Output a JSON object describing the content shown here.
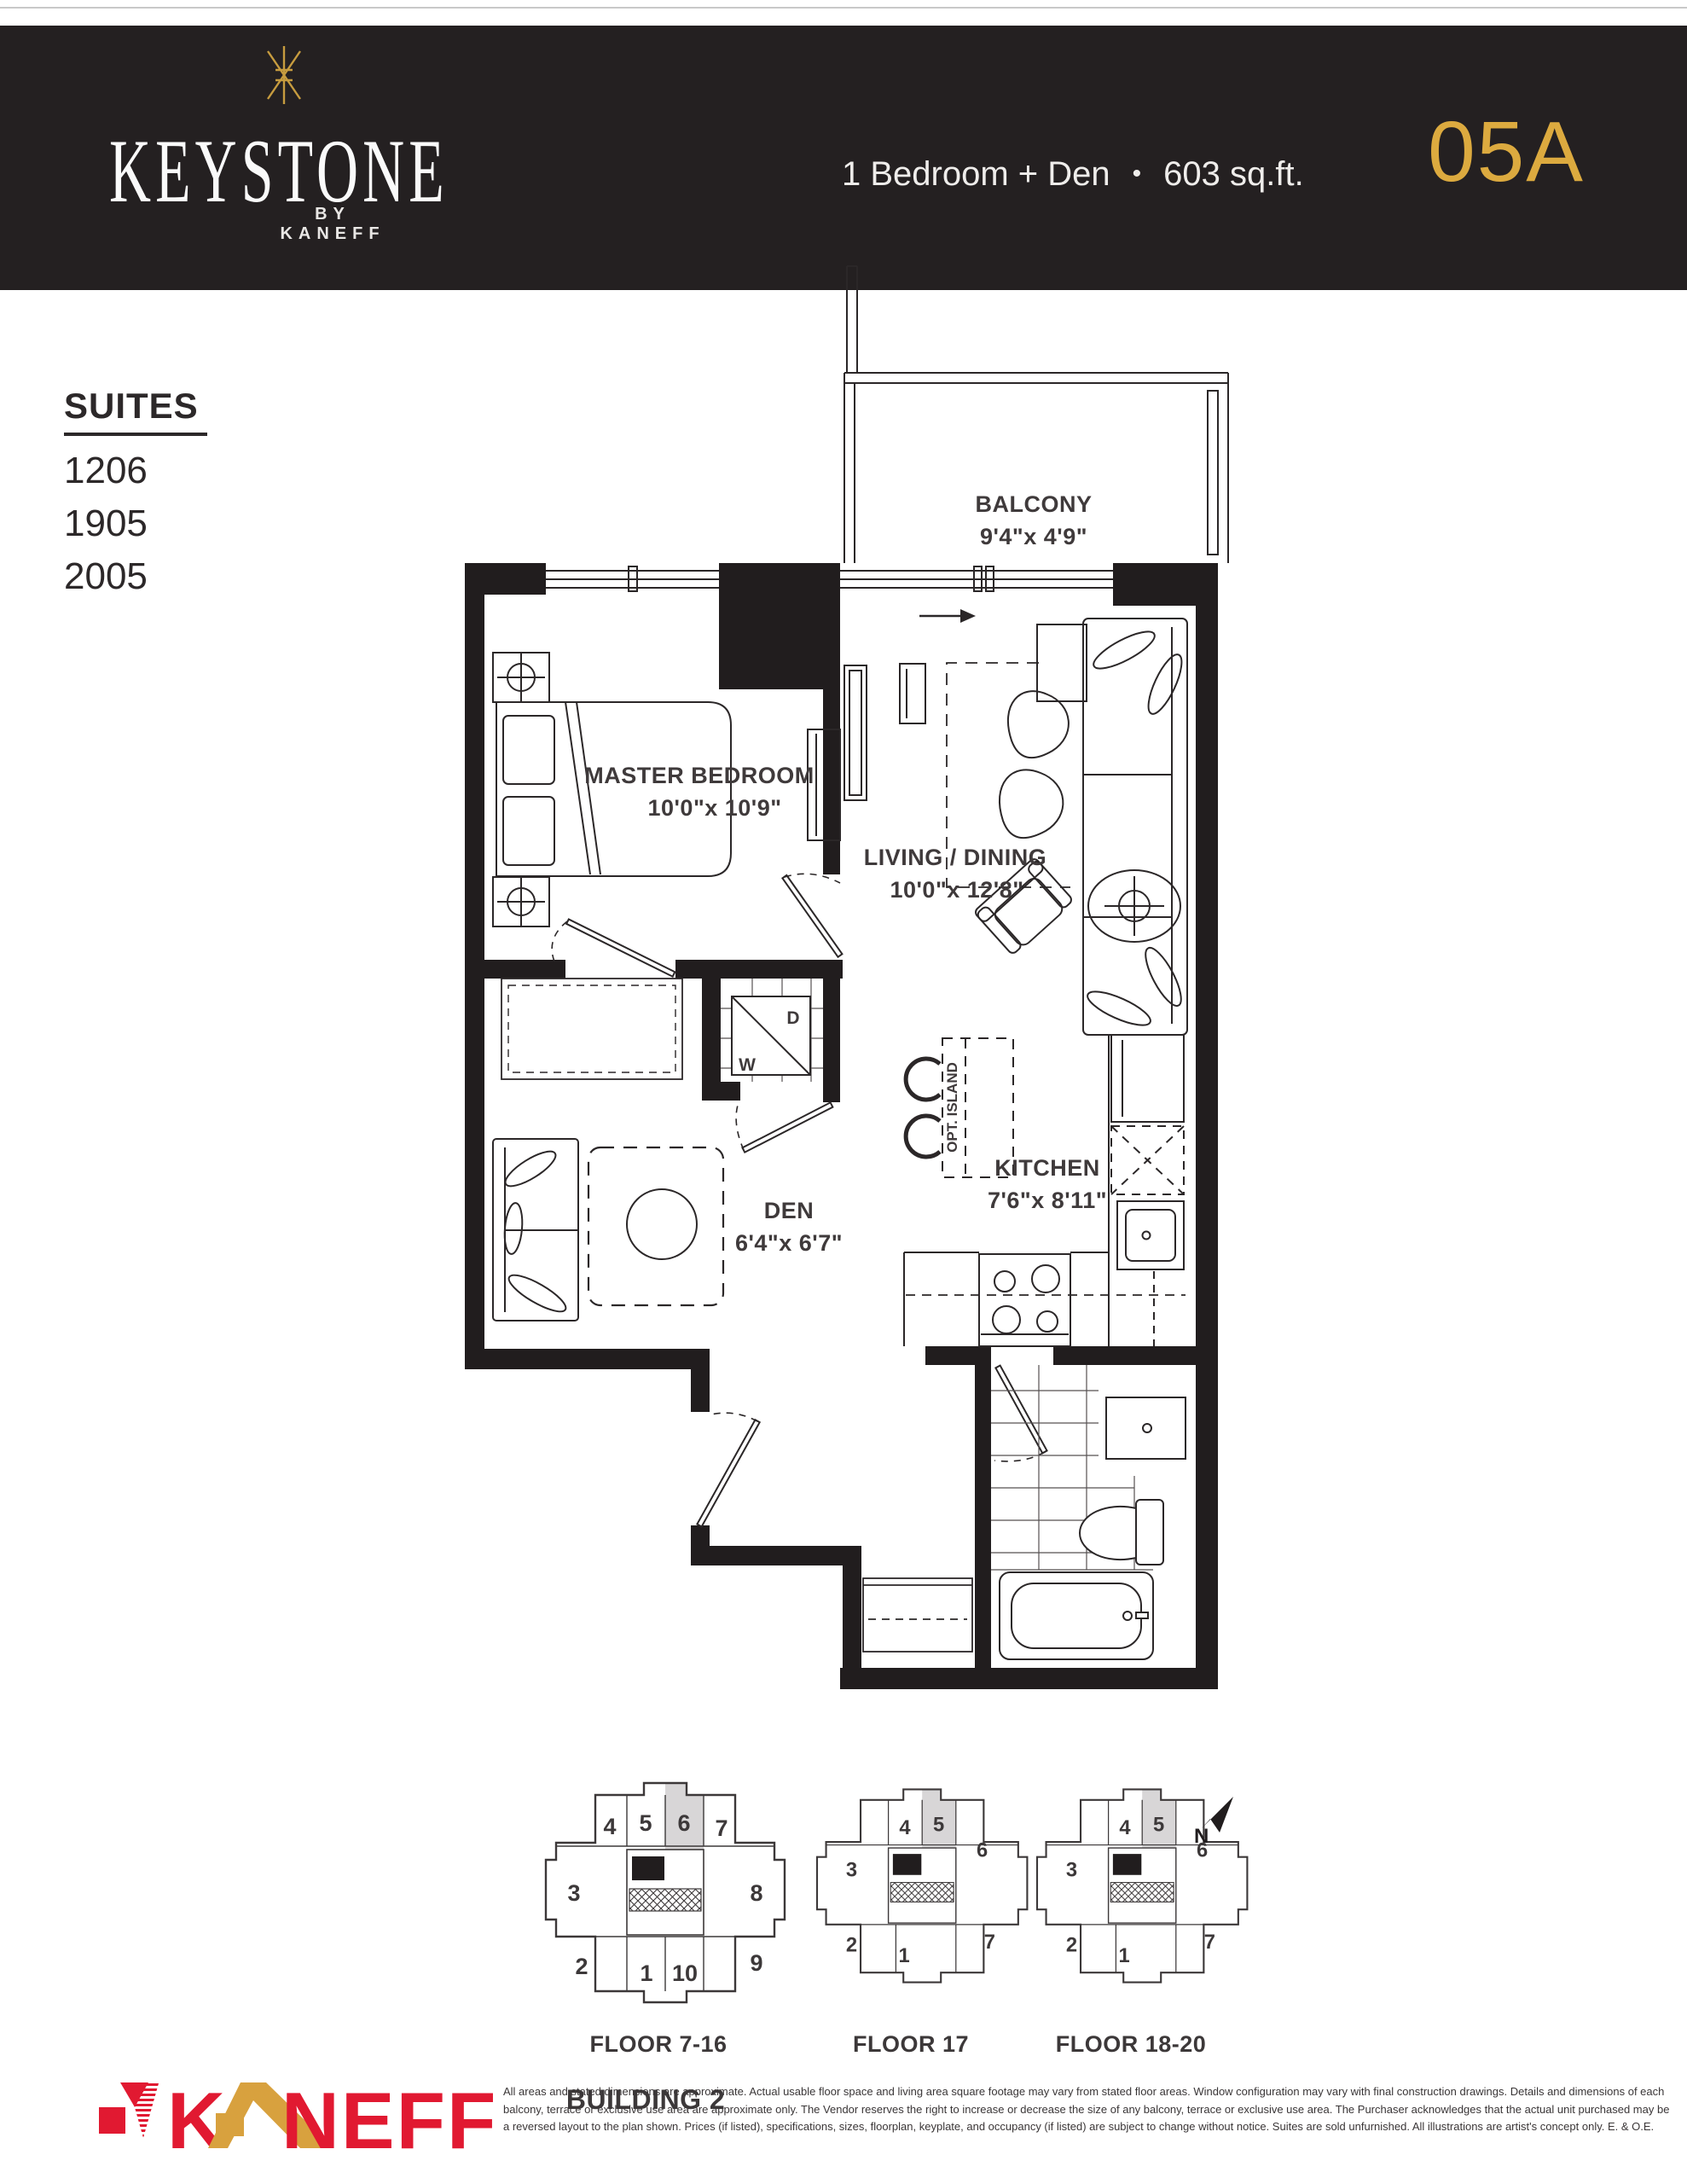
{
  "header": {
    "brand": "KEYSTONE",
    "byline": "BY KANEFF",
    "unit_type": "1 Bedroom + Den",
    "bullet": "•",
    "area": "603 sq.ft.",
    "unit_number": "05A",
    "colors": {
      "gold": "#DCAA3F",
      "background": "#242021"
    }
  },
  "suites": {
    "title": "SUITES",
    "numbers": [
      "1206",
      "1905",
      "2005"
    ]
  },
  "floorplan": {
    "rooms": [
      {
        "name": "BALCONY",
        "dims": "9'4\"x 4'9\""
      },
      {
        "name": "MASTER BEDROOM",
        "dims": "10'0\"x 10'9\""
      },
      {
        "name": "LIVING / DINING",
        "dims": "10'0\"x 12'8\""
      },
      {
        "name": "DEN",
        "dims": "6'4\"x 6'7\""
      },
      {
        "name": "KITCHEN",
        "dims": "7'6\"x 8'11\""
      }
    ],
    "appliances": {
      "washer": "W",
      "dryer": "D"
    },
    "optional_island": "OPT. ISLAND"
  },
  "keyplates": [
    {
      "label": "FLOOR 7-16",
      "highlighted": "6",
      "units": [
        "4",
        "5",
        "6",
        "7",
        "3",
        "8",
        "2",
        "1",
        "10",
        "9"
      ]
    },
    {
      "label": "FLOOR 17",
      "highlighted": "5",
      "units": [
        "3",
        "4",
        "5",
        "6",
        "2",
        "1",
        "7"
      ]
    },
    {
      "label": "FLOOR 18-20",
      "highlighted": "5",
      "units": [
        "3",
        "4",
        "5",
        "6",
        "2",
        "1",
        "7"
      ]
    }
  ],
  "building": "BUILDING 2",
  "compass": "N",
  "footer": {
    "logo": "KANEFF",
    "logo_parts": {
      "k": "K",
      "rest": "NEFF"
    },
    "disclaimer": [
      "All areas and stated dimensions are approximate. Actual usable floor space and living area square footage may vary from stated floor areas. Window configuration may vary with final construction drawings. Details and dimensions of each",
      "balcony, terrace or exclusive use area are approximate only. The Vendor reserves the right to increase or decrease the size of any balcony, terrace or exclusive use area. The Purchaser acknowledges that the actual unit purchased may be",
      "a reversed layout to the plan shown. Prices (if listed), specifications, sizes, floorplan, keyplate, and occupancy (if listed) are subject to change without notice. Suites are sold unfurnished. All illustrations are artist's concept only. E. & O.E."
    ]
  }
}
